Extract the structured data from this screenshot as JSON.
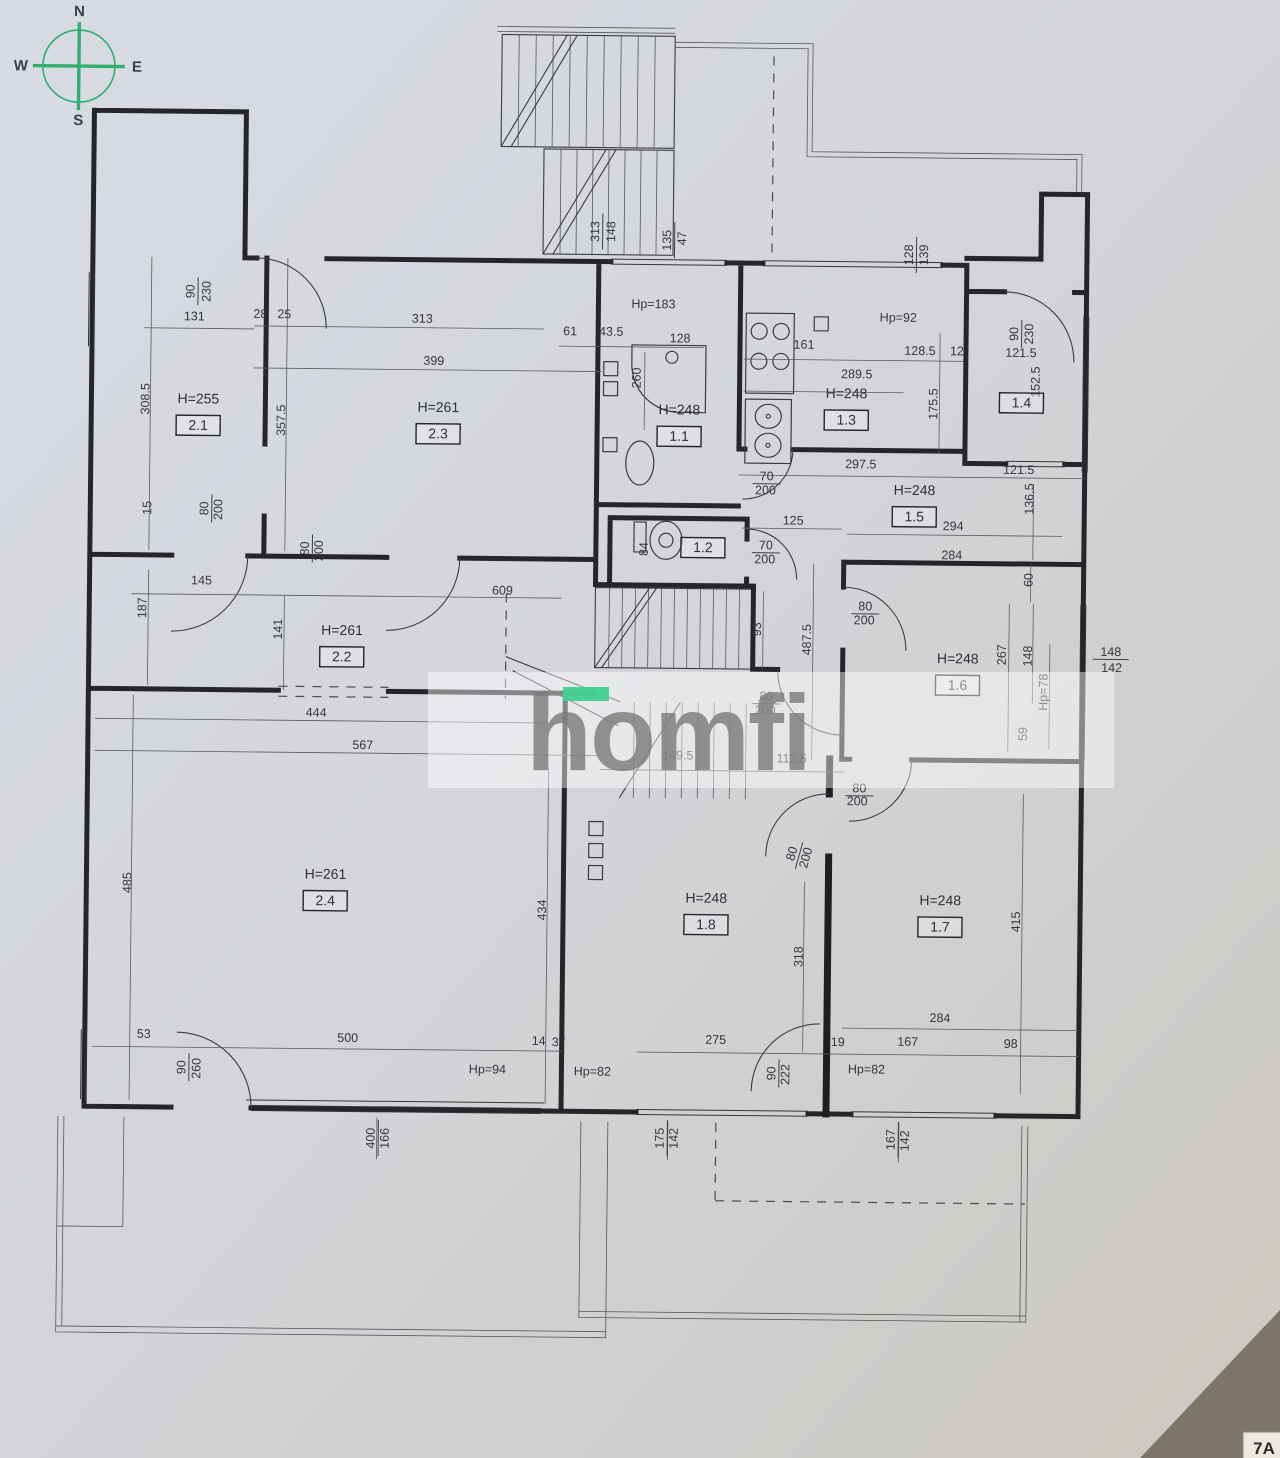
{
  "compass": {
    "n": "N",
    "e": "E",
    "s": "S",
    "w": "W"
  },
  "watermark": {
    "text": "homfi"
  },
  "corner_label": "7A",
  "colors": {
    "compass_green": "#2fae70",
    "watermark_accent": "#41d08e",
    "paper": "#d3d5da",
    "line": "#26262a"
  },
  "rooms": [
    {
      "id": "2.1",
      "h": "H=255",
      "x": 195,
      "y": 408
    },
    {
      "id": "2.3",
      "h": "H=261",
      "x": 435,
      "y": 414
    },
    {
      "id": "2.2",
      "h": "H=261",
      "x": 341,
      "y": 638
    },
    {
      "id": "2.4",
      "h": "H=261",
      "x": 327,
      "y": 882
    },
    {
      "id": "1.1",
      "h": "H=248",
      "x": 676,
      "y": 414
    },
    {
      "id": "1.2",
      "h": "",
      "x": 701,
      "y": 547
    },
    {
      "id": "1.3",
      "h": "H=248",
      "x": 843,
      "y": 396
    },
    {
      "id": "1.4",
      "h": "",
      "x": 1018,
      "y": 399
    },
    {
      "id": "1.5",
      "h": "H=248",
      "x": 912,
      "y": 492
    },
    {
      "id": "1.6",
      "h": "H=248",
      "x": 957,
      "y": 660
    },
    {
      "id": "1.7",
      "h": "H=248",
      "x": 942,
      "y": 902
    },
    {
      "id": "1.8",
      "h": "H=248",
      "x": 708,
      "y": 902
    }
  ],
  "labels": [
    {
      "t": "313",
      "x": 594,
      "y": 232,
      "r": -90,
      "b": 1
    },
    {
      "t": "148",
      "x": 610,
      "y": 232,
      "r": -90
    },
    {
      "t": "135",
      "x": 666,
      "y": 240,
      "r": -90,
      "b": 1
    },
    {
      "t": "47",
      "x": 681,
      "y": 238,
      "r": -90
    },
    {
      "t": "128",
      "x": 908,
      "y": 252,
      "r": -90,
      "b": 1
    },
    {
      "t": "139",
      "x": 923,
      "y": 252,
      "r": -90
    },
    {
      "t": "90",
      "x": 190,
      "y": 296,
      "r": -90,
      "b": 1
    },
    {
      "t": "230",
      "x": 206,
      "y": 296,
      "r": -90
    },
    {
      "t": "131",
      "x": 190,
      "y": 325
    },
    {
      "t": "28",
      "x": 256,
      "y": 322
    },
    {
      "t": "25",
      "x": 280,
      "y": 322
    },
    {
      "t": "313",
      "x": 418,
      "y": 325
    },
    {
      "t": "399",
      "x": 430,
      "y": 367
    },
    {
      "t": "61",
      "x": 566,
      "y": 336
    },
    {
      "t": "43.5",
      "x": 607,
      "y": 336
    },
    {
      "t": "Hp=183",
      "x": 649,
      "y": 308
    },
    {
      "t": "128",
      "x": 676,
      "y": 342
    },
    {
      "t": "260",
      "x": 637,
      "y": 378,
      "r": -90
    },
    {
      "t": "161",
      "x": 800,
      "y": 347
    },
    {
      "t": "128.5",
      "x": 916,
      "y": 352
    },
    {
      "t": "12",
      "x": 953,
      "y": 352
    },
    {
      "t": "Hp=92",
      "x": 894,
      "y": 319
    },
    {
      "t": "289.5",
      "x": 853,
      "y": 376
    },
    {
      "t": "175.5",
      "x": 934,
      "y": 401,
      "r": -90
    },
    {
      "t": "90",
      "x": 1014,
      "y": 330,
      "r": -90,
      "b": 1
    },
    {
      "t": "230",
      "x": 1029,
      "y": 330,
      "r": -90
    },
    {
      "t": "121.5",
      "x": 1017,
      "y": 353
    },
    {
      "t": "152.5",
      "x": 1036,
      "y": 378,
      "r": -90
    },
    {
      "t": "121.5",
      "x": 1016,
      "y": 470
    },
    {
      "t": "136.5",
      "x": 1031,
      "y": 495,
      "r": -90
    },
    {
      "t": "297.5",
      "x": 858,
      "y": 466
    },
    {
      "t": "294",
      "x": 951,
      "y": 527
    },
    {
      "t": "284",
      "x": 950,
      "y": 556
    },
    {
      "t": "125",
      "x": 791,
      "y": 523
    },
    {
      "t": "70",
      "x": 764,
      "y": 479,
      "b": 1
    },
    {
      "t": "200",
      "x": 763,
      "y": 493
    },
    {
      "t": "70",
      "x": 764,
      "y": 548,
      "b": 1
    },
    {
      "t": "200",
      "x": 763,
      "y": 562
    },
    {
      "t": "84",
      "x": 646,
      "y": 549,
      "r": -90
    },
    {
      "t": "308.5",
      "x": 146,
      "y": 404,
      "r": -90
    },
    {
      "t": "357.5",
      "x": 282,
      "y": 424,
      "r": -90
    },
    {
      "t": "15",
      "x": 149,
      "y": 513,
      "r": -90
    },
    {
      "t": "80",
      "x": 206,
      "y": 513,
      "r": -90,
      "b": 1
    },
    {
      "t": "200",
      "x": 220,
      "y": 514,
      "r": -90
    },
    {
      "t": "80",
      "x": 307,
      "y": 552,
      "r": -90,
      "b": 1
    },
    {
      "t": "200",
      "x": 321,
      "y": 554,
      "r": -90
    },
    {
      "t": "145",
      "x": 200,
      "y": 589
    },
    {
      "t": "187",
      "x": 145,
      "y": 613,
      "r": -90
    },
    {
      "t": "141",
      "x": 281,
      "y": 633,
      "r": -90
    },
    {
      "t": "444",
      "x": 316,
      "y": 720
    },
    {
      "t": "567",
      "x": 363,
      "y": 752
    },
    {
      "t": "609",
      "x": 501,
      "y": 596
    },
    {
      "t": "93",
      "x": 760,
      "y": 628,
      "r": -90
    },
    {
      "t": "487.5",
      "x": 810,
      "y": 638,
      "r": -90
    },
    {
      "t": "80",
      "x": 766,
      "y": 699,
      "b": 1
    },
    {
      "t": "200",
      "x": 765,
      "y": 713
    },
    {
      "t": "149.5",
      "x": 678,
      "y": 759
    },
    {
      "t": "112.5",
      "x": 792,
      "y": 761
    },
    {
      "t": "80",
      "x": 864,
      "y": 608,
      "b": 1
    },
    {
      "t": "200",
      "x": 863,
      "y": 622
    },
    {
      "t": "60",
      "x": 1031,
      "y": 576,
      "r": -90
    },
    {
      "t": "267",
      "x": 1005,
      "y": 651,
      "r": -90
    },
    {
      "t": "148",
      "x": 1031,
      "y": 652,
      "r": -90
    },
    {
      "t": "Hp=78",
      "x": 1047,
      "y": 688,
      "r": -90
    },
    {
      "t": "148",
      "x": 1110,
      "y": 651,
      "b": 1
    },
    {
      "t": "142",
      "x": 1111,
      "y": 667
    },
    {
      "t": "59",
      "x": 1027,
      "y": 730,
      "r": -90
    },
    {
      "t": "485",
      "x": 133,
      "y": 888,
      "r": -90
    },
    {
      "t": "434",
      "x": 548,
      "y": 911,
      "r": -90
    },
    {
      "t": "318",
      "x": 805,
      "y": 955,
      "r": -90
    },
    {
      "t": "415",
      "x": 1022,
      "y": 918,
      "r": -90
    },
    {
      "t": "80",
      "x": 797,
      "y": 853,
      "r": -75,
      "b": 1
    },
    {
      "t": "200",
      "x": 811,
      "y": 857,
      "r": -75
    },
    {
      "t": "80",
      "x": 860,
      "y": 790,
      "b": 1
    },
    {
      "t": "200",
      "x": 858,
      "y": 803
    },
    {
      "t": "53",
      "x": 147,
      "y": 1043
    },
    {
      "t": "90",
      "x": 189,
      "y": 1072,
      "r": -90,
      "b": 1
    },
    {
      "t": "260",
      "x": 204,
      "y": 1073,
      "r": -90
    },
    {
      "t": "500",
      "x": 351,
      "y": 1045
    },
    {
      "t": "Hp=94",
      "x": 491,
      "y": 1075
    },
    {
      "t": "14",
      "x": 542,
      "y": 1046
    },
    {
      "t": "37",
      "x": 562,
      "y": 1047
    },
    {
      "t": "Hp=82",
      "x": 596,
      "y": 1076
    },
    {
      "t": "400",
      "x": 379,
      "y": 1141,
      "r": -90,
      "b": 1
    },
    {
      "t": "166",
      "x": 393,
      "y": 1141,
      "r": -90
    },
    {
      "t": "275",
      "x": 719,
      "y": 1043
    },
    {
      "t": "90",
      "x": 779,
      "y": 1072,
      "r": -90,
      "b": 1
    },
    {
      "t": "222",
      "x": 793,
      "y": 1073,
      "r": -90
    },
    {
      "t": "19",
      "x": 841,
      "y": 1044
    },
    {
      "t": "167",
      "x": 911,
      "y": 1043
    },
    {
      "t": "98",
      "x": 1014,
      "y": 1044
    },
    {
      "t": "284",
      "x": 943,
      "y": 1019
    },
    {
      "t": "Hp=82",
      "x": 870,
      "y": 1071
    },
    {
      "t": "175",
      "x": 668,
      "y": 1138,
      "r": -90,
      "b": 1
    },
    {
      "t": "142",
      "x": 682,
      "y": 1138,
      "r": -90
    },
    {
      "t": "167",
      "x": 899,
      "y": 1137,
      "r": -90,
      "b": 1
    },
    {
      "t": "142",
      "x": 913,
      "y": 1138,
      "r": -90
    }
  ]
}
